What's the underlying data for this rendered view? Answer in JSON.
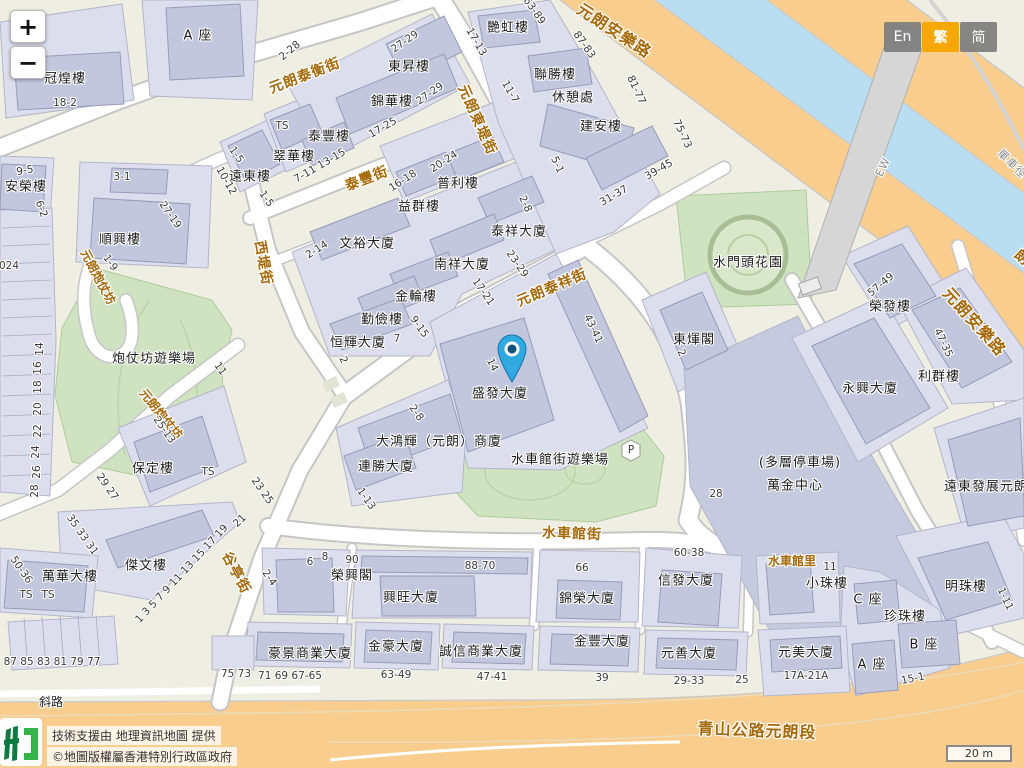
{
  "ui": {
    "zoom_in": "+",
    "zoom_out": "−",
    "language_buttons": [
      {
        "label": "En",
        "active": false
      },
      {
        "label": "繁",
        "active": true
      },
      {
        "label": "简",
        "active": false
      }
    ],
    "attribution": {
      "line1": "技術支援由 地理資訊地圖 提供",
      "line2": "©地圖版權屬香港特別行政區政府"
    },
    "scale_bar": "20 m",
    "marker": {
      "name": "location-pin",
      "x": 512,
      "y": 382,
      "building": "盛發大廈"
    }
  },
  "colors": {
    "lang_active": "#f7a800",
    "pin_blue": "#2fa9e0",
    "road_major": "#f8cd8e",
    "water": "#b9def2",
    "park": "#cfe3c0",
    "building_block": "#dcdeee",
    "building_footprint": "#c3c7dd",
    "street_name_text": "#a5690a"
  },
  "map_labels": {
    "streets": [
      {
        "t": "元朗泰衡街",
        "x": 305,
        "y": 76,
        "r": -21
      },
      {
        "t": "泰豐街",
        "x": 367,
        "y": 179,
        "r": -21
      },
      {
        "t": "元朗東堤街",
        "x": 477,
        "y": 120,
        "r": 66
      },
      {
        "t": "元朗泰祥街",
        "x": 552,
        "y": 288,
        "r": -23
      },
      {
        "t": "西堤街",
        "x": 263,
        "y": 263,
        "r": 80
      },
      {
        "t": "元朗炮仗坊",
        "x": 98,
        "y": 277,
        "r": 62,
        "c": "sm"
      },
      {
        "t": "元朗炮仗坊",
        "x": 161,
        "y": 414,
        "r": 51,
        "c": "sm"
      },
      {
        "t": "谷亭街",
        "x": 236,
        "y": 573,
        "r": 62
      },
      {
        "t": "水車館街",
        "x": 572,
        "y": 534,
        "r": 2
      },
      {
        "t": "水車館里",
        "x": 792,
        "y": 561,
        "r": 0,
        "c": "sm"
      },
      {
        "t": "元朗安樂路",
        "x": 614,
        "y": 31,
        "r": 33,
        "c": "big"
      },
      {
        "t": "元朗安樂路",
        "x": 974,
        "y": 322,
        "r": 48,
        "c": "big"
      },
      {
        "t": "青山公路元朗段",
        "x": 757,
        "y": 731,
        "r": 2,
        "c": "big"
      },
      {
        "t": "朗業街",
        "x": 1033,
        "y": 268,
        "r": 42
      }
    ],
    "buildings": [
      {
        "t": "冠煌樓",
        "x": 65,
        "y": 79
      },
      {
        "t": "A 座",
        "x": 198,
        "y": 36
      },
      {
        "t": "安榮樓",
        "x": 26,
        "y": 187
      },
      {
        "t": "順興樓",
        "x": 120,
        "y": 240
      },
      {
        "t": "遠東樓",
        "x": 250,
        "y": 177
      },
      {
        "t": "翠華樓",
        "x": 294,
        "y": 157
      },
      {
        "t": "泰豐樓",
        "x": 329,
        "y": 137
      },
      {
        "t": "東昇樓",
        "x": 409,
        "y": 67
      },
      {
        "t": "錦華樓",
        "x": 392,
        "y": 102
      },
      {
        "t": "普利樓",
        "x": 458,
        "y": 184
      },
      {
        "t": "益群樓",
        "x": 419,
        "y": 207
      },
      {
        "t": "文裕大廈",
        "x": 367,
        "y": 244
      },
      {
        "t": "南祥大廈",
        "x": 462,
        "y": 265
      },
      {
        "t": "泰祥大廈",
        "x": 519,
        "y": 232
      },
      {
        "t": "金輪樓",
        "x": 416,
        "y": 297
      },
      {
        "t": "勤儉樓",
        "x": 382,
        "y": 320
      },
      {
        "t": "恒輝大廈",
        "x": 358,
        "y": 343
      },
      {
        "t": "艷虹樓",
        "x": 508,
        "y": 28
      },
      {
        "t": "聯勝樓",
        "x": 555,
        "y": 75
      },
      {
        "t": "休憩處",
        "x": 573,
        "y": 98
      },
      {
        "t": "建安樓",
        "x": 601,
        "y": 127
      },
      {
        "t": "水門頭花園",
        "x": 748,
        "y": 263
      },
      {
        "t": "東煇閣",
        "x": 694,
        "y": 340
      },
      {
        "t": "榮發樓",
        "x": 890,
        "y": 307
      },
      {
        "t": "利群樓",
        "x": 939,
        "y": 377
      },
      {
        "t": "永興大廈",
        "x": 870,
        "y": 389
      },
      {
        "t": "(多層停車場)",
        "x": 800,
        "y": 463
      },
      {
        "t": "萬金中心",
        "x": 795,
        "y": 486
      },
      {
        "t": "遠東發展元朗大廈",
        "x": 1000,
        "y": 487
      },
      {
        "t": "明珠樓",
        "x": 966,
        "y": 587
      },
      {
        "t": "小珠樓",
        "x": 827,
        "y": 584
      },
      {
        "t": "C 座",
        "x": 868,
        "y": 600
      },
      {
        "t": "珍珠樓",
        "x": 905,
        "y": 617
      },
      {
        "t": "B 座",
        "x": 924,
        "y": 645
      },
      {
        "t": "A 座",
        "x": 872,
        "y": 665
      },
      {
        "t": "元美大廈",
        "x": 806,
        "y": 653
      },
      {
        "t": "榮興閣",
        "x": 352,
        "y": 576
      },
      {
        "t": "興旺大廈",
        "x": 411,
        "y": 598
      },
      {
        "t": "錦榮大廈",
        "x": 587,
        "y": 599
      },
      {
        "t": "信發大廈",
        "x": 686,
        "y": 581
      },
      {
        "t": "金豐大廈",
        "x": 602,
        "y": 642
      },
      {
        "t": "元善大廈",
        "x": 689,
        "y": 654
      },
      {
        "t": "豪景商業大廈",
        "x": 310,
        "y": 654
      },
      {
        "t": "金豪大廈",
        "x": 396,
        "y": 647
      },
      {
        "t": "誠信商業大廈",
        "x": 481,
        "y": 652
      },
      {
        "t": "傑文樓",
        "x": 146,
        "y": 566
      },
      {
        "t": "萬華大樓",
        "x": 70,
        "y": 577
      },
      {
        "t": "保定樓",
        "x": 153,
        "y": 469
      },
      {
        "t": "炮仗坊遊樂場",
        "x": 154,
        "y": 359
      },
      {
        "t": "水車館街遊樂場",
        "x": 560,
        "y": 460
      },
      {
        "t": "盛發大廈",
        "x": 500,
        "y": 394
      },
      {
        "t": "大鴻輝（元朗）商廈",
        "x": 439,
        "y": 442
      },
      {
        "t": "連勝大廈",
        "x": 386,
        "y": 467
      },
      {
        "t": "斜路",
        "x": 51,
        "y": 702,
        "c": "sm"
      }
    ],
    "numbers": [
      {
        "t": "18-2",
        "x": 65,
        "y": 103
      },
      {
        "t": "9-5",
        "x": 25,
        "y": 171,
        "r": -10
      },
      {
        "t": "6-2",
        "x": 41,
        "y": 209,
        "r": 70
      },
      {
        "t": "3-1",
        "x": 122,
        "y": 177
      },
      {
        "t": "27-19",
        "x": 170,
        "y": 215,
        "r": 55
      },
      {
        "t": "024",
        "x": 9,
        "y": 266
      },
      {
        "t": "1-9",
        "x": 110,
        "y": 263,
        "r": 55
      },
      {
        "t": "2-28",
        "x": 290,
        "y": 51,
        "r": -40
      },
      {
        "t": "27-29",
        "x": 405,
        "y": 42,
        "r": -35
      },
      {
        "t": "27-29",
        "x": 430,
        "y": 94,
        "r": -35
      },
      {
        "t": "17-25",
        "x": 383,
        "y": 128,
        "r": -30
      },
      {
        "t": "TS",
        "x": 282,
        "y": 126
      },
      {
        "t": "1-5",
        "x": 236,
        "y": 155,
        "r": 55
      },
      {
        "t": "10-12",
        "x": 226,
        "y": 181,
        "r": 60
      },
      {
        "t": "1-5",
        "x": 266,
        "y": 199,
        "r": 55
      },
      {
        "t": "7-11 13-15",
        "x": 320,
        "y": 166,
        "r": -30
      },
      {
        "t": "16-18",
        "x": 403,
        "y": 181,
        "r": -33
      },
      {
        "t": "20-24",
        "x": 444,
        "y": 162,
        "r": -33
      },
      {
        "t": "2-14",
        "x": 317,
        "y": 250,
        "r": -33
      },
      {
        "t": "17-21",
        "x": 483,
        "y": 292,
        "r": 55
      },
      {
        "t": "23-29",
        "x": 517,
        "y": 264,
        "r": 55
      },
      {
        "t": "2-8",
        "x": 525,
        "y": 204,
        "r": 65
      },
      {
        "t": "7",
        "x": 397,
        "y": 339
      },
      {
        "t": "9-15",
        "x": 419,
        "y": 327,
        "r": 55
      },
      {
        "t": "2",
        "x": 343,
        "y": 360,
        "r": 65
      },
      {
        "t": "17-13",
        "x": 476,
        "y": 42,
        "r": 60
      },
      {
        "t": "63-89",
        "x": 534,
        "y": 11,
        "r": 55
      },
      {
        "t": "87-83",
        "x": 584,
        "y": 45,
        "r": 55
      },
      {
        "t": "11-7",
        "x": 510,
        "y": 92,
        "r": 60
      },
      {
        "t": "81-77",
        "x": 636,
        "y": 90,
        "r": 65
      },
      {
        "t": "5-1",
        "x": 557,
        "y": 165,
        "r": 65
      },
      {
        "t": "75-73",
        "x": 682,
        "y": 134,
        "r": 65
      },
      {
        "t": "39-45",
        "x": 659,
        "y": 170,
        "r": -30
      },
      {
        "t": "31-37",
        "x": 614,
        "y": 196,
        "r": -30
      },
      {
        "t": "14",
        "x": 492,
        "y": 365,
        "r": 65
      },
      {
        "t": "43-41",
        "x": 593,
        "y": 329,
        "r": 65
      },
      {
        "t": "2-8",
        "x": 416,
        "y": 413,
        "r": 55
      },
      {
        "t": "1-13",
        "x": 366,
        "y": 499,
        "r": 55
      },
      {
        "t": "23 25",
        "x": 262,
        "y": 491,
        "r": 55
      },
      {
        "t": "28",
        "x": 716,
        "y": 494
      },
      {
        "t": "2",
        "x": 681,
        "y": 353,
        "r": 65
      },
      {
        "t": "57-49",
        "x": 881,
        "y": 285,
        "r": -40
      },
      {
        "t": "47-35",
        "x": 943,
        "y": 343,
        "r": 65
      },
      {
        "t": "1-11",
        "x": 1005,
        "y": 599,
        "r": 65
      },
      {
        "t": "11",
        "x": 830,
        "y": 567
      },
      {
        "t": "17A-21A",
        "x": 806,
        "y": 676
      },
      {
        "t": "15-1",
        "x": 913,
        "y": 679,
        "r": -12
      },
      {
        "t": "60-38",
        "x": 689,
        "y": 553
      },
      {
        "t": "66",
        "x": 582,
        "y": 568
      },
      {
        "t": "39",
        "x": 602,
        "y": 678
      },
      {
        "t": "29-33",
        "x": 689,
        "y": 681
      },
      {
        "t": "25",
        "x": 742,
        "y": 680
      },
      {
        "t": "88-70",
        "x": 480,
        "y": 566
      },
      {
        "t": "6",
        "x": 310,
        "y": 562
      },
      {
        "t": "8",
        "x": 325,
        "y": 557
      },
      {
        "t": "90",
        "x": 352,
        "y": 560
      },
      {
        "t": "2-4",
        "x": 269,
        "y": 578,
        "r": 55
      },
      {
        "t": "71 69 67-65",
        "x": 290,
        "y": 676
      },
      {
        "t": "63-49",
        "x": 396,
        "y": 675
      },
      {
        "t": "47-41",
        "x": 492,
        "y": 677
      },
      {
        "t": "75 73",
        "x": 236,
        "y": 674
      },
      {
        "t": "87 85 83 81 79 77",
        "x": 52,
        "y": 662
      },
      {
        "t": "35 33 31",
        "x": 82,
        "y": 535,
        "r": 55
      },
      {
        "t": "1 3 5 7 9 11 13 15 17 19",
        "x": 182,
        "y": 574,
        "r": -47
      },
      {
        "t": "21",
        "x": 240,
        "y": 521,
        "r": -45
      },
      {
        "t": "29 27",
        "x": 107,
        "y": 487,
        "r": 55
      },
      {
        "t": "25-13",
        "x": 164,
        "y": 430,
        "r": 55
      },
      {
        "t": "11",
        "x": 220,
        "y": 369,
        "r": 55
      },
      {
        "t": "50-36",
        "x": 21,
        "y": 570,
        "r": 55
      },
      {
        "t": "TS",
        "x": 208,
        "y": 472
      },
      {
        "t": "TS",
        "x": 26,
        "y": 595
      },
      {
        "t": "TS",
        "x": 48,
        "y": 595
      },
      {
        "t": "P",
        "x": 631,
        "y": 450
      },
      {
        "t": "14",
        "x": 40,
        "y": 349,
        "r": -90
      },
      {
        "t": "16",
        "x": 38,
        "y": 368,
        "r": -90
      },
      {
        "t": "18",
        "x": 38,
        "y": 387,
        "r": -90
      },
      {
        "t": "20",
        "x": 38,
        "y": 409,
        "r": -90
      },
      {
        "t": "22",
        "x": 38,
        "y": 431,
        "r": -90
      },
      {
        "t": "24",
        "x": 36,
        "y": 452,
        "r": -90
      },
      {
        "t": "26",
        "x": 37,
        "y": 472,
        "r": -90
      },
      {
        "t": "28",
        "x": 35,
        "y": 491,
        "r": -90
      }
    ],
    "misc": [
      {
        "t": "EW",
        "x": 883,
        "y": 167,
        "r": -64
      },
      {
        "t": "單車徑",
        "x": 1012,
        "y": 164,
        "r": 45
      }
    ]
  }
}
